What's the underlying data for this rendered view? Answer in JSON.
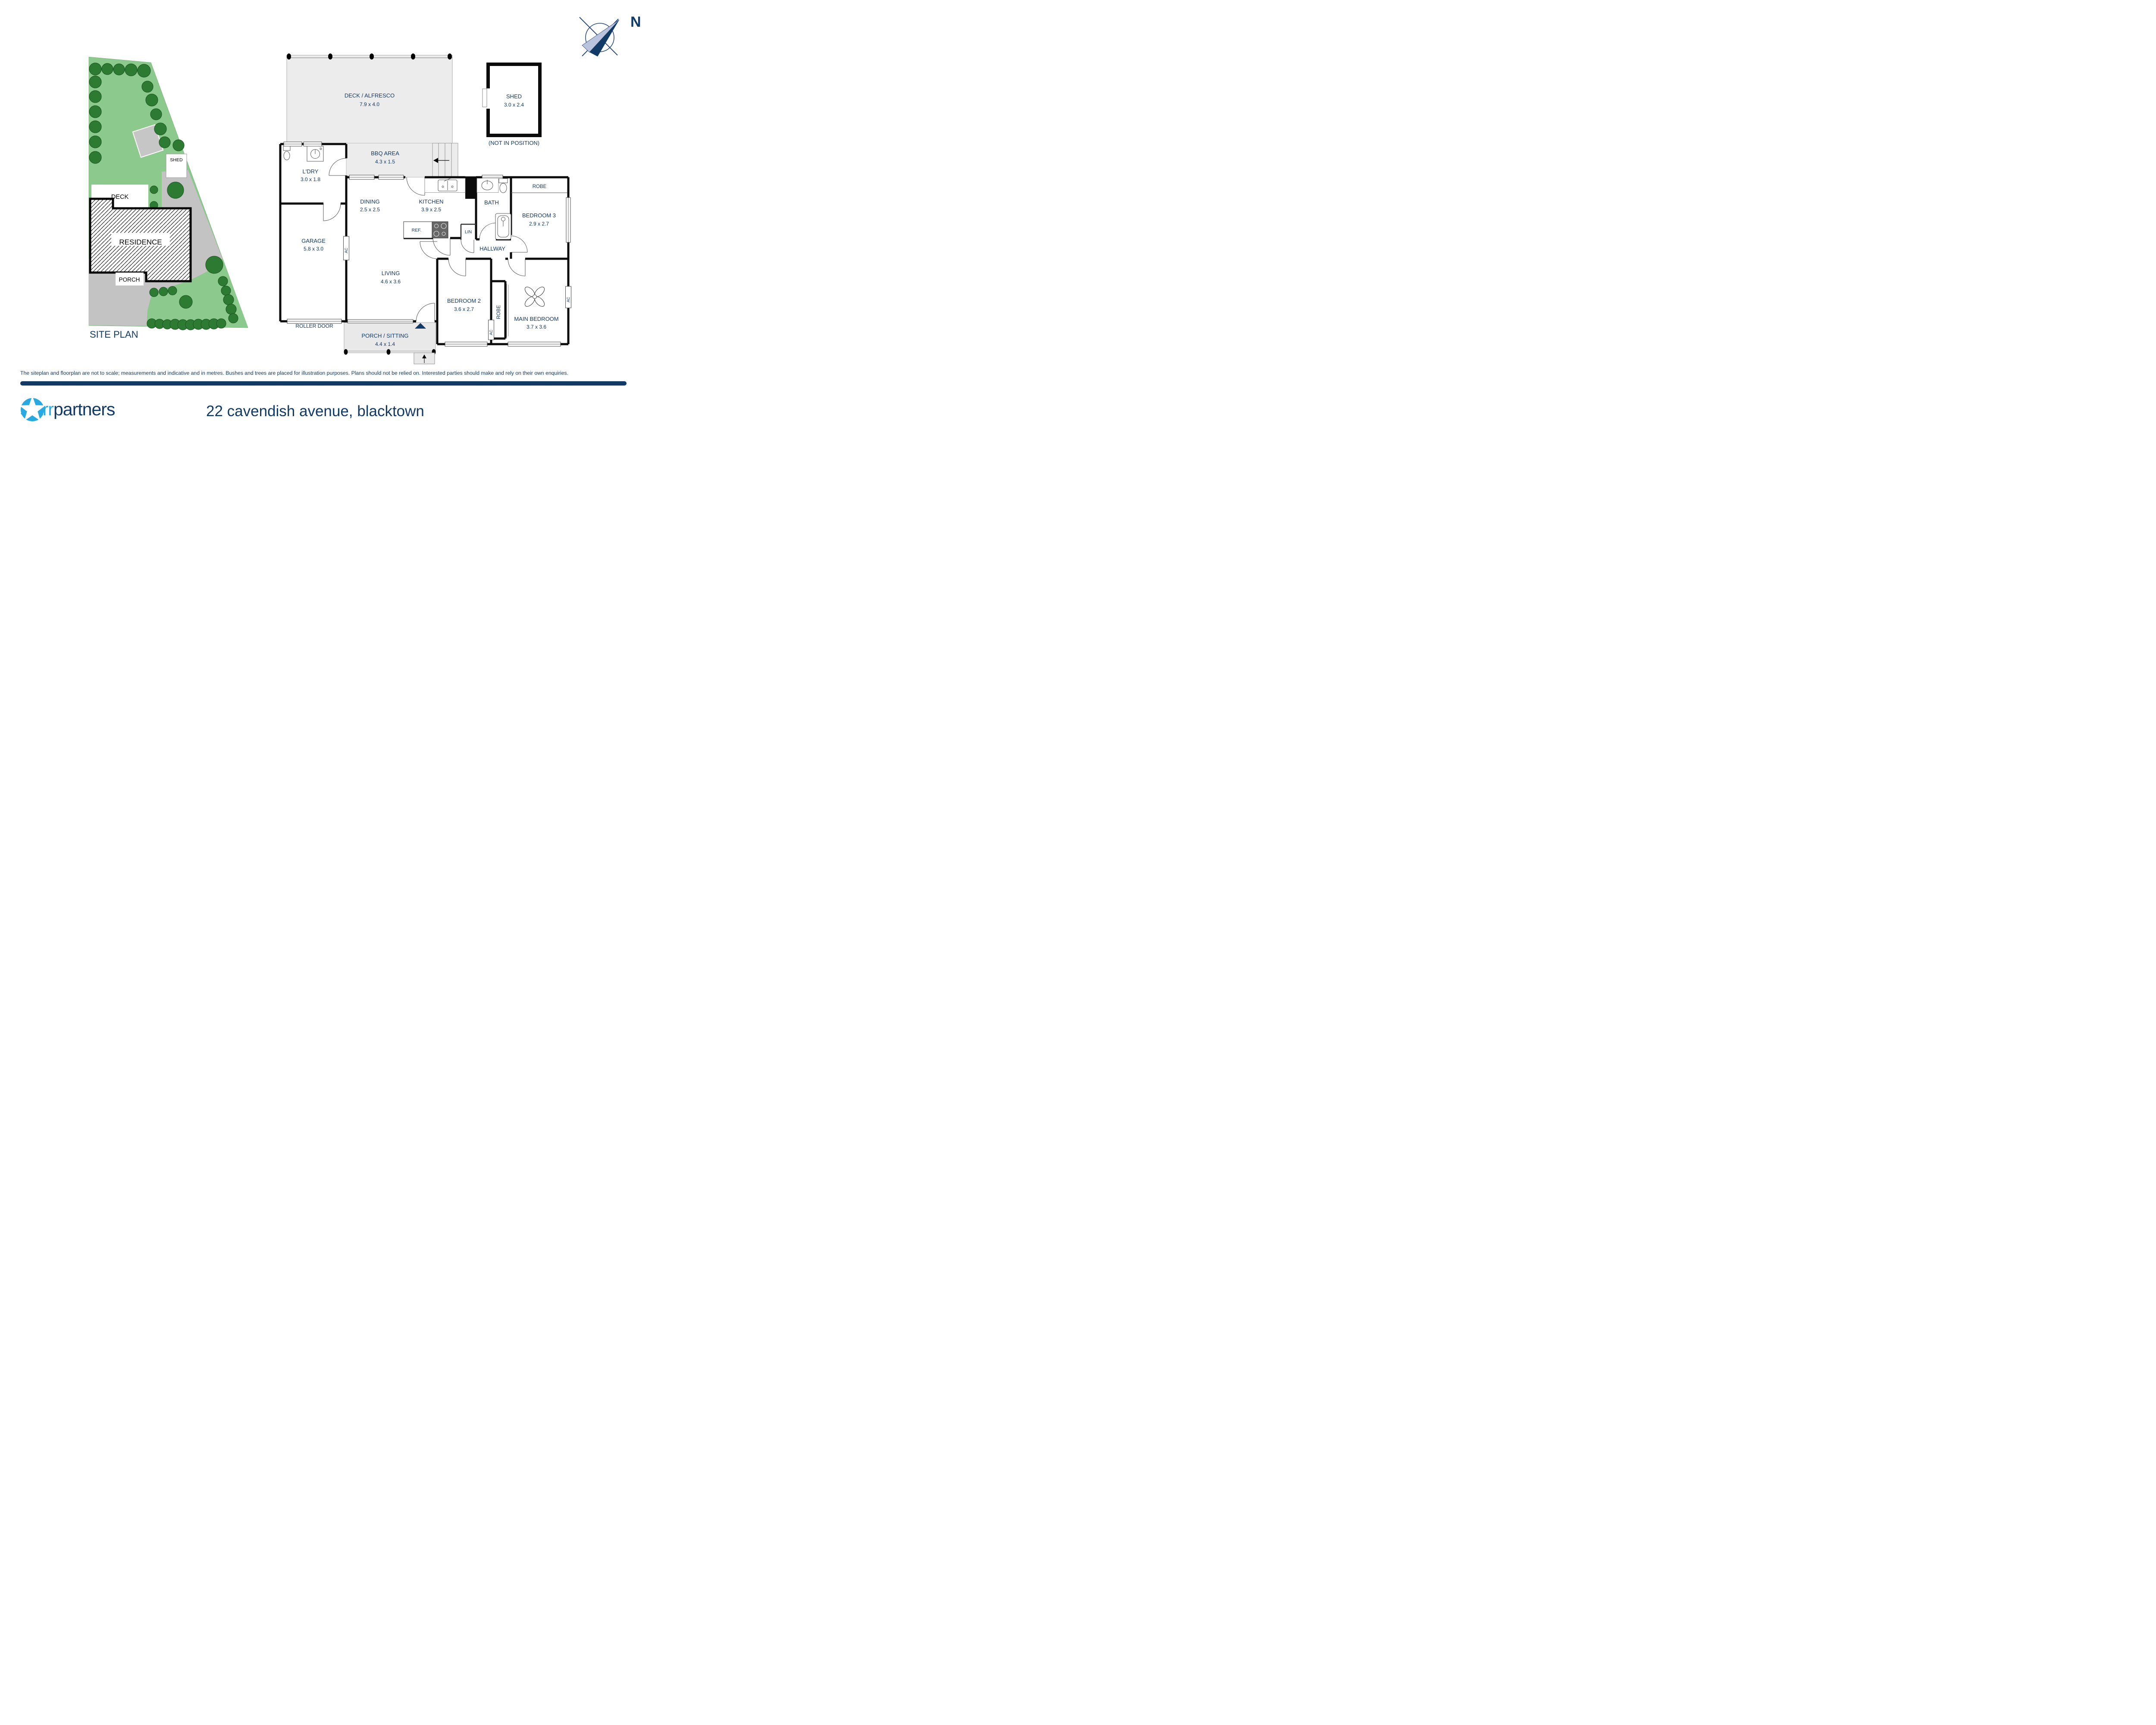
{
  "compass": {
    "n_label": "N"
  },
  "site_plan": {
    "title": "SITE PLAN",
    "labels": {
      "residence": "RESIDENCE",
      "deck": "DECK",
      "porch": "PORCH",
      "shed": "SHED"
    }
  },
  "floorplan": {
    "deck_alfresco": {
      "name": "DECK / ALFRESCO",
      "dims": "7.9 x 4.0"
    },
    "shed": {
      "name": "SHED",
      "dims": "3.0 x 2.4",
      "note": "(NOT IN POSITION)"
    },
    "bbq": {
      "name": "BBQ AREA",
      "dims": "4.3 x 1.5"
    },
    "ldry": {
      "name": "L'DRY",
      "dims": "3.0 x 1.8"
    },
    "garage": {
      "name": "GARAGE",
      "dims": "5.8 x 3.0"
    },
    "roller_door": "ROLLER DOOR",
    "dining": {
      "name": "DINING",
      "dims": "2.5 x 2.5"
    },
    "kitchen": {
      "name": "KITCHEN",
      "dims": "3.9 x 2.5"
    },
    "ref": "REF.",
    "lin": "LIN",
    "bath": {
      "name": "BATH"
    },
    "hallway": "HALLWAY",
    "living": {
      "name": "LIVING",
      "dims": "4.6 x 3.6"
    },
    "bedroom2": {
      "name": "BEDROOM 2",
      "dims": "3.6 x 2.7"
    },
    "bedroom3": {
      "name": "BEDROOM 3",
      "dims": "2.9 x 2.7"
    },
    "main_bedroom": {
      "name": "MAIN BEDROOM",
      "dims": "3.7 x 3.6"
    },
    "robe": "ROBE",
    "porch_sitting": {
      "name": "PORCH / SITTING",
      "dims": "4.4 x 1.4"
    },
    "ac": "AC"
  },
  "footer": {
    "disclaimer": "The siteplan and floorplan are not to scale; measurements and indicative and in metres. Bushes and trees are placed for illustration purposes. Plans should not be relied on. Interested parties should make and rely on their own enquiries.",
    "brand": {
      "starr": "starr",
      "partners": "partners"
    },
    "address": "22 cavendish avenue, blacktown"
  },
  "colors": {
    "navy": "#123a67",
    "light_blue": "#29a9e1",
    "lawn_green": "#8cc98c",
    "tree_green": "#2d7a33",
    "driveway_gray": "#c3c3c3",
    "deck_gray": "#ececec",
    "wall_black": "#0b0b0b"
  }
}
